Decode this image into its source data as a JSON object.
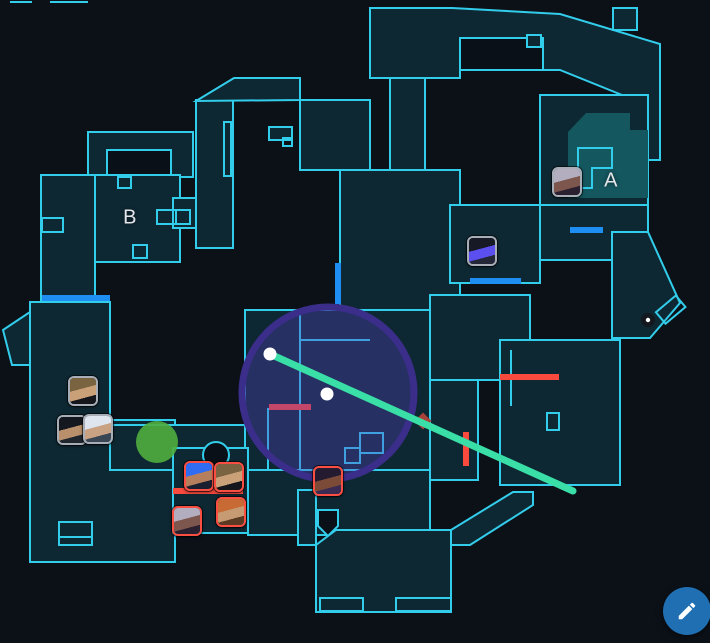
{
  "colors": {
    "bg": "#0c1118",
    "map_fill": "#0e2833",
    "map_stroke": "#33cdec",
    "site_fill": "#14575f",
    "door_color": "#1f8ef2",
    "wall_color": "#fa4a3e"
  },
  "sites": [
    {
      "label": "A",
      "x": 611,
      "y": 181
    },
    {
      "label": "B",
      "x": 130,
      "y": 218
    }
  ],
  "team_borders": {
    "ally": "#a8aeb8",
    "enemy": "#fb4e42"
  },
  "agents": [
    {
      "name": "chamber",
      "team": "ally",
      "x": 83,
      "y": 391,
      "hair": "#7a6340",
      "skin": "#c9a078",
      "accent": "#15151c"
    },
    {
      "name": "viper",
      "team": "ally",
      "x": 72,
      "y": 430,
      "hair": "#15191f",
      "skin": "#b9906b",
      "accent": "#20262e"
    },
    {
      "name": "jett",
      "team": "ally",
      "x": 98,
      "y": 429,
      "hair": "#dfe5ee",
      "skin": "#c9a183",
      "accent": "#3b4654"
    },
    {
      "name": "omen",
      "team": "ally",
      "x": 482,
      "y": 251,
      "hair": "#171a24",
      "skin": "#5b4ff0",
      "accent": "#232738"
    },
    {
      "name": "reyna",
      "team": "ally",
      "x": 567,
      "y": 182,
      "hair": "#b3aebf",
      "skin": "#7d574d",
      "accent": "#2a2030"
    },
    {
      "name": "neon",
      "team": "enemy",
      "x": 199,
      "y": 476,
      "hair": "#2f6cf2",
      "skin": "#b57e5d",
      "accent": "#1b2030"
    },
    {
      "name": "chamber",
      "team": "enemy",
      "x": 229,
      "y": 477,
      "hair": "#7a6340",
      "skin": "#c9a078",
      "accent": "#15151c"
    },
    {
      "name": "breach",
      "team": "enemy",
      "x": 231,
      "y": 512,
      "hair": "#c76a33",
      "skin": "#c69a73",
      "accent": "#5a3a22"
    },
    {
      "name": "reyna",
      "team": "enemy",
      "x": 187,
      "y": 521,
      "hair": "#b3aebf",
      "skin": "#7d574d",
      "accent": "#2a2030"
    },
    {
      "name": "astra",
      "team": "enemy",
      "x": 328,
      "y": 481,
      "hair": "#241b31",
      "skin": "#7c4b37",
      "accent": "#3b2b52"
    }
  ],
  "drawings": {
    "zone_circle": {
      "cx": 328,
      "cy": 393,
      "r": 86,
      "fill": "rgba(88,66,198,0.33)",
      "stroke": "#3b2d8a",
      "stroke_width": 7
    },
    "trajectory_line": {
      "x1": 270,
      "y1": 354,
      "x2": 573,
      "y2": 491,
      "color": "#39dfa6",
      "width": 7
    },
    "waypoints": [
      {
        "x": 270,
        "y": 354
      },
      {
        "x": 327,
        "y": 394
      }
    ],
    "impact_marker": {
      "x": 423,
      "y": 421,
      "color": "#a84138"
    },
    "smoke_circle": {
      "cx": 157,
      "cy": 442,
      "r": 21,
      "color": "#4fae3e"
    },
    "dot_marker": {
      "x": 648,
      "y": 320,
      "fill": "#14181f",
      "center": "#ffffff"
    }
  },
  "doors": [
    {
      "x1": 42,
      "y1": 298,
      "x2": 110,
      "y2": 298
    },
    {
      "x1": 338,
      "y1": 263,
      "x2": 338,
      "y2": 304
    },
    {
      "x1": 470,
      "y1": 281,
      "x2": 521,
      "y2": 281
    },
    {
      "x1": 570,
      "y1": 230,
      "x2": 603,
      "y2": 230
    }
  ],
  "walls": [
    {
      "x1": 269,
      "y1": 407,
      "x2": 311,
      "y2": 407
    },
    {
      "x1": 173,
      "y1": 491,
      "x2": 243,
      "y2": 491
    },
    {
      "x1": 466,
      "y1": 432,
      "x2": 466,
      "y2": 466
    },
    {
      "x1": 500,
      "y1": 377,
      "x2": 559,
      "y2": 377
    }
  ],
  "edit_button": {
    "icon": "pencil-icon",
    "background": "#1f6fb2"
  }
}
